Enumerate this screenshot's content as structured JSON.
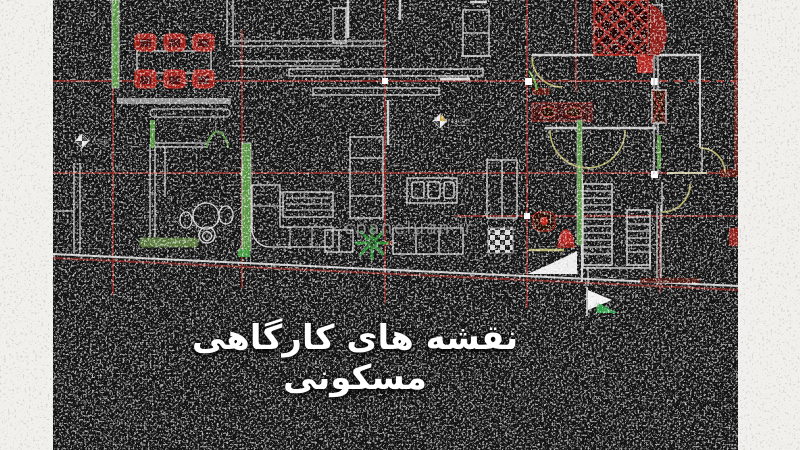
{
  "page": {
    "background": "#f2f0ec"
  },
  "overlay": {
    "title": "نقشه های کارگاهی مسکونی",
    "watermark": "cpaneluan.ir"
  },
  "drawing": {
    "type": "cad-residential-floor-plan",
    "canvas_color": "#141414",
    "colors": {
      "grid_red": "#7d2823",
      "furniture_red": "#b3241c",
      "wall_gray": "#cfcfcf",
      "door_olive": "#b9b368",
      "green": "#57963f"
    },
    "level_markers": [
      {
        "value": "0.56"
      },
      {
        "value": "±0.00"
      }
    ]
  }
}
